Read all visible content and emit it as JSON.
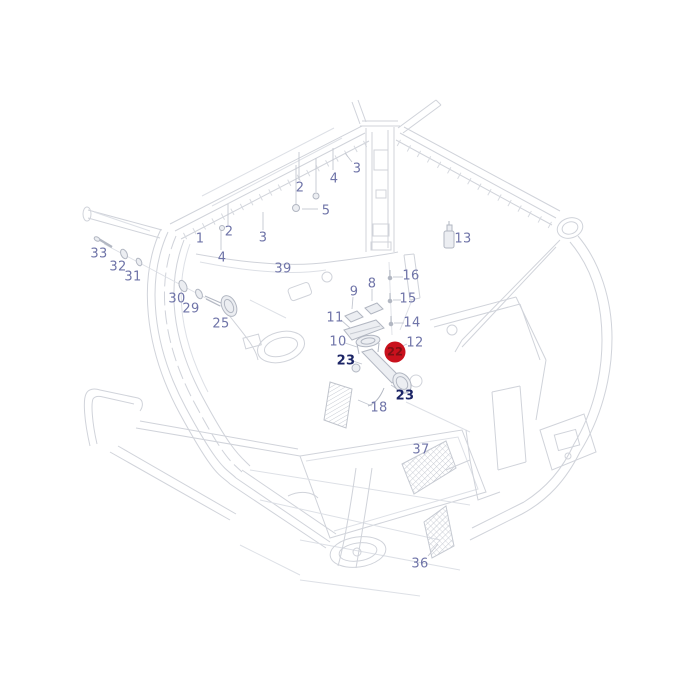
{
  "diagram": {
    "description": "exploded-parts-line-drawing-of-tractor-cab-interior",
    "selected_part": "22",
    "colors": {
      "background": "#ffffff",
      "line": "#d0d3da",
      "line_strong": "#b2b7c2",
      "label": "#6f74a8",
      "label_selected": "#1c2566",
      "badge_fill": "#c9111d",
      "badge_text": "#7d1014"
    },
    "labels": [
      {
        "text": "1",
        "x": 200,
        "y": 239,
        "kind": "ref"
      },
      {
        "text": "2",
        "x": 229,
        "y": 232,
        "kind": "ref"
      },
      {
        "text": "3",
        "x": 263,
        "y": 238,
        "kind": "ref"
      },
      {
        "text": "4",
        "x": 222,
        "y": 258,
        "kind": "ref"
      },
      {
        "text": "2",
        "x": 300,
        "y": 188,
        "kind": "ref"
      },
      {
        "text": "4",
        "x": 334,
        "y": 179,
        "kind": "ref"
      },
      {
        "text": "3",
        "x": 357,
        "y": 169,
        "kind": "ref"
      },
      {
        "text": "5",
        "x": 326,
        "y": 211,
        "kind": "ref"
      },
      {
        "text": "13",
        "x": 463,
        "y": 239,
        "kind": "ref"
      },
      {
        "text": "39",
        "x": 283,
        "y": 269,
        "kind": "ref"
      },
      {
        "text": "16",
        "x": 411,
        "y": 276,
        "kind": "ref"
      },
      {
        "text": "15",
        "x": 408,
        "y": 299,
        "kind": "ref"
      },
      {
        "text": "14",
        "x": 412,
        "y": 323,
        "kind": "ref"
      },
      {
        "text": "12",
        "x": 415,
        "y": 343,
        "kind": "ref"
      },
      {
        "text": "9",
        "x": 354,
        "y": 292,
        "kind": "ref"
      },
      {
        "text": "8",
        "x": 372,
        "y": 284,
        "kind": "ref"
      },
      {
        "text": "11",
        "x": 335,
        "y": 318,
        "kind": "ref"
      },
      {
        "text": "10",
        "x": 338,
        "y": 342,
        "kind": "ref"
      },
      {
        "text": "33",
        "x": 99,
        "y": 254,
        "kind": "ref"
      },
      {
        "text": "32",
        "x": 118,
        "y": 267,
        "kind": "ref"
      },
      {
        "text": "31",
        "x": 133,
        "y": 277,
        "kind": "ref"
      },
      {
        "text": "30",
        "x": 177,
        "y": 299,
        "kind": "ref"
      },
      {
        "text": "29",
        "x": 191,
        "y": 309,
        "kind": "ref"
      },
      {
        "text": "25",
        "x": 221,
        "y": 324,
        "kind": "ref"
      },
      {
        "text": "23",
        "x": 346,
        "y": 361,
        "kind": "ref-bold"
      },
      {
        "text": "22",
        "x": 395,
        "y": 352,
        "kind": "ref-badge"
      },
      {
        "text": "23",
        "x": 405,
        "y": 396,
        "kind": "ref-bold"
      },
      {
        "text": "18",
        "x": 379,
        "y": 408,
        "kind": "ref"
      },
      {
        "text": "37",
        "x": 421,
        "y": 450,
        "kind": "ref"
      },
      {
        "text": "36",
        "x": 420,
        "y": 564,
        "kind": "ref"
      }
    ]
  }
}
